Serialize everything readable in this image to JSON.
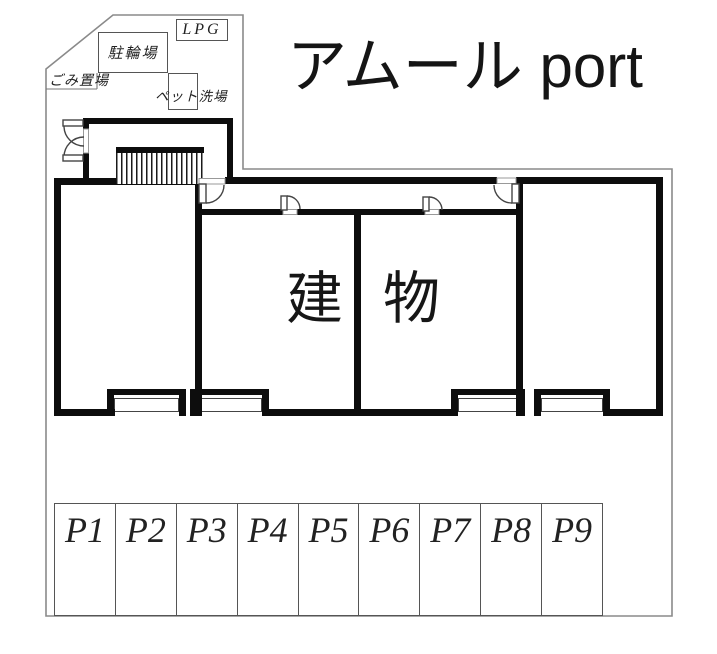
{
  "title": "アムール port",
  "colors": {
    "wall": "#0d0d0d",
    "boundary_line": "#8a8a8a",
    "thin_line": "#555555",
    "text": "#1a1a1a",
    "background": "#ffffff"
  },
  "site": {
    "labels": {
      "bicycle_parking": "駐輪場",
      "garbage_area": "ごみ置場",
      "pet_wash": "ペット洗場",
      "lpg": "LPG"
    },
    "building_label": {
      "first_char": "建",
      "second_char": "物"
    }
  },
  "parking": {
    "stalls": [
      "P1",
      "P2",
      "P3",
      "P4",
      "P5",
      "P6",
      "P7",
      "P8",
      "P9"
    ]
  }
}
